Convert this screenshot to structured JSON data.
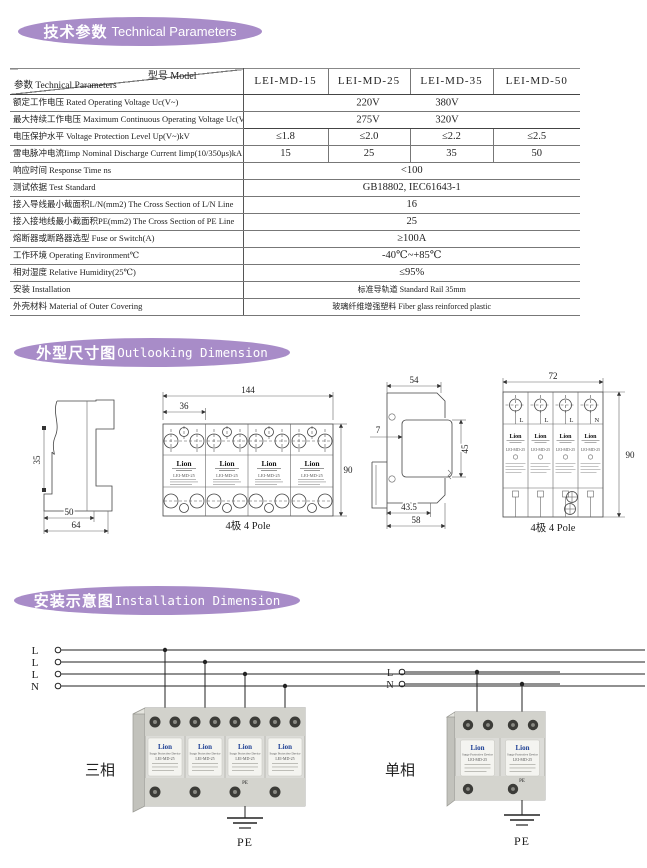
{
  "sections": {
    "tech": {
      "title_cn": "技术参数",
      "title_en": "Technical Parameters"
    },
    "outline": {
      "title_cn": "外型尺寸图",
      "title_en": "Outlooking Dimension"
    },
    "install": {
      "title_cn": "安装示意图",
      "title_en": "Installation Dimension"
    }
  },
  "table": {
    "corner_top": "型号 Model",
    "corner_bottom": "参数 Technical Parameters",
    "models": [
      "LEI-MD-15",
      "LEI-MD-25",
      "LEI-MD-35",
      "LEI-MD-50"
    ],
    "rows": [
      {
        "label": "额定工作电压 Rated Operating Voltage Uc(V~)",
        "values": [
          "220V",
          "380V"
        ]
      },
      {
        "label": "最大持续工作电压 Maximum Continuous Operating Voltage Uc(V~)",
        "values": [
          "275V",
          "320V"
        ]
      },
      {
        "label": "电压保护水平 Voltage Protection Level Up(V~)kV",
        "values": [
          "≤1.8",
          "≤2.0",
          "≤2.2",
          "≤2.5"
        ]
      },
      {
        "label": "雷电脉冲电流Iimp Nominal Discharge Current Iimp(10/350μs)kA",
        "values": [
          "15",
          "25",
          "35",
          "50"
        ]
      },
      {
        "label": "响应时间 Response Time ns",
        "values": [
          "<100"
        ]
      },
      {
        "label": "测试依据 Test Standard",
        "values": [
          "GB18802, IEC61643-1"
        ]
      },
      {
        "label": "接入导线最小截面积L/N(mm2) The Cross Section of L/N Line",
        "values": [
          "16"
        ]
      },
      {
        "label": "接入接地线最小截面积PE(mm2) The Cross Section of PE Line",
        "values": [
          "25"
        ]
      },
      {
        "label": "熔断器或断路器选型 Fuse or Switch(A)",
        "values": [
          "≥100A"
        ]
      },
      {
        "label": "工作环境 Operating Environment℃",
        "values": [
          "-40℃~+85℃"
        ]
      },
      {
        "label": "相对湿度 Relative Humidity(25℃)",
        "values": [
          "≤95%"
        ]
      },
      {
        "label": "安装 Installation",
        "values": [
          "标准导轨道 Standard Rail 35mm"
        ]
      },
      {
        "label": "外壳材料 Material of Outer Covering",
        "values": [
          "玻璃纤维增强塑料 Fiber glass reinforced plastic"
        ]
      }
    ]
  },
  "drawings": {
    "module": {
      "logo": "Lion",
      "model": "LEI-MD-25"
    },
    "side_small": {
      "dim_rail": "35",
      "dim_depth1": "50",
      "dim_depth2": "64"
    },
    "front_wide": {
      "dim_total": "144",
      "dim_module": "36",
      "dim_height": "90",
      "caption": "4极 4 Pole"
    },
    "side_deep": {
      "dim_top": "54",
      "dim_offset": "7",
      "dim_body": "45",
      "dim_bottom1": "43.5",
      "dim_bottom2": "58"
    },
    "front_narrow": {
      "dim_total": "72",
      "dim_height": "90",
      "caption": "4极 4 Pole",
      "terminals": [
        "L",
        "L",
        "L",
        "N"
      ]
    }
  },
  "installation": {
    "device": {
      "logo": "Lion",
      "subtitle": "Surge Protective Device",
      "model": "LEI-MD-25"
    },
    "three_phase": {
      "label": "三相",
      "line_labels": [
        "L",
        "L",
        "L",
        "N"
      ],
      "device_pe": "PE",
      "pe": "PE"
    },
    "single_phase": {
      "label": "单相",
      "line_labels": [
        "L",
        "N"
      ],
      "device_pe": "PE",
      "pe": "PE"
    }
  },
  "colors": {
    "banner": "#a88cc8",
    "logo_blue": "#1d3f94"
  }
}
